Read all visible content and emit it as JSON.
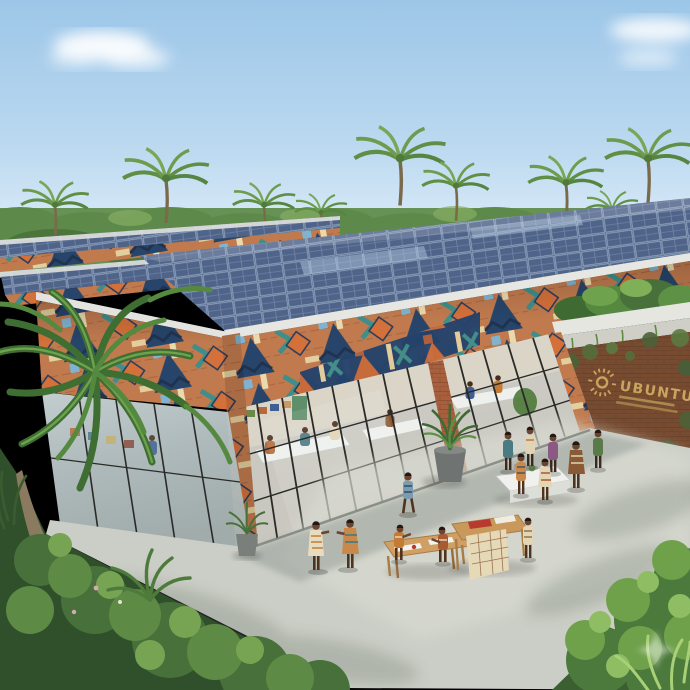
{
  "image": {
    "type": "photorealistic architectural rendering",
    "subject": "Solar-roofed community innovation hub with African geometric print facade, glass walls, tropical palm setting and people working in a sunlit courtyard",
    "width_px": 690,
    "height_px": 690
  },
  "sign": {
    "title": "UBUNTU",
    "logo": "radiating sun emblem",
    "subtitle_lines_count": 2,
    "subtitle_text": "(two lines of small illegible gold lettering)",
    "text_color": "#c9a45e"
  },
  "building": {
    "roof": "photovoltaic solar-panel arrays on three stepped flat roof bands with white edge trim",
    "fascia": "African geometric mosaic band in terracotta, navy, teal, orange and cream",
    "walls": "full-height glass curtain wall with black mullions and patterned brick piers",
    "entrance": "white concrete planter canopy with tropical plants above an ivy-covered brick sign wall"
  },
  "environment": {
    "sky": "clear light blue with wispy white clouds",
    "horizon": "dense tropical forest with emergent palm trees",
    "foreground": "large palm tree and lush garden beds flanking a concrete courtyard"
  },
  "courtyard": {
    "people_count_approx": 13,
    "activities": [
      "children drawing at a wooden table",
      "textile display table",
      "group around a white project table",
      "standing conversation",
      "person walking"
    ],
    "furniture": [
      "wooden drawing table",
      "wooden textile table",
      "long white project table"
    ],
    "potted_plants_count": 2
  },
  "palette": {
    "sky_top": "#a7cdeb",
    "sky_horizon": "#e8f3fb",
    "foliage_dark": "#30502b",
    "foliage_mid": "#47703a",
    "foliage_light": "#76a452",
    "solar_panel": "#4a5c7d",
    "solar_grid": "#93a7c2",
    "roof_edge": "#e6e7e2",
    "fascia_terracotta": "#c07a4e",
    "fascia_navy": "#27456a",
    "fascia_teal": "#3f8e8a",
    "fascia_orange": "#d4703a",
    "fascia_cream": "#ead9ae",
    "glass": "#b7c3c5",
    "pavement": "#cbcec6",
    "shadow": "#98a09a",
    "brick": "#a85f3e",
    "sign_gold": "#c9a45e"
  },
  "watermark": {
    "shape": "four-point sparkle",
    "position": "bottom-right foliage"
  }
}
